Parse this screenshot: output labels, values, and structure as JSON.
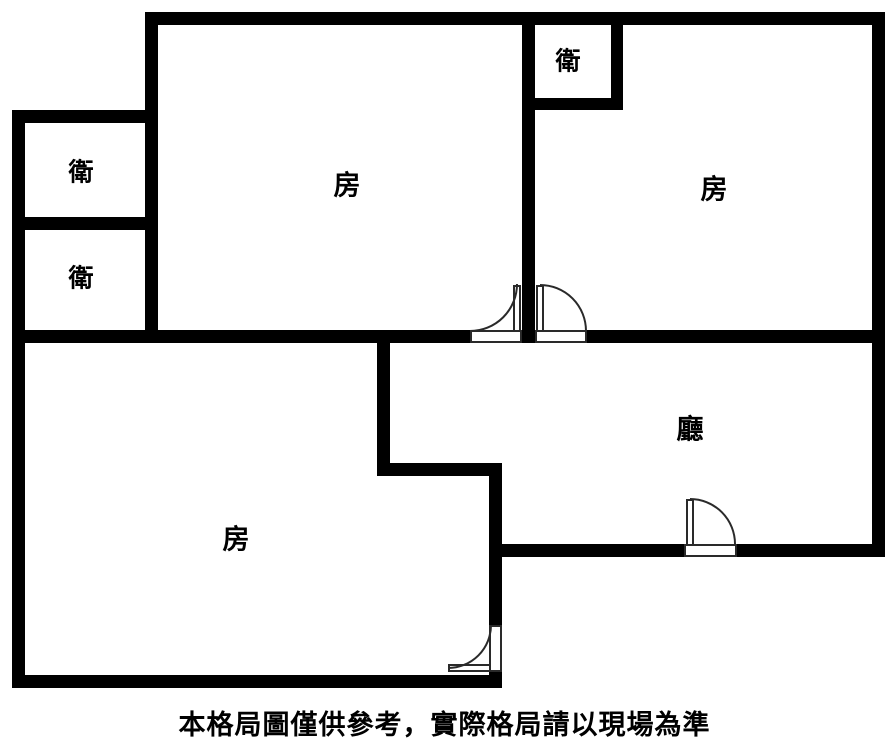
{
  "plan": {
    "background_color": "#ffffff",
    "wall_color": "#000000",
    "door_line_color": "#2a2a2a"
  },
  "rooms": [
    {
      "id": "bathroom-upper-left",
      "label": "衛"
    },
    {
      "id": "bathroom-lower-left",
      "label": "衛"
    },
    {
      "id": "bathroom-top-right",
      "label": "衛"
    },
    {
      "id": "bedroom-top-center",
      "label": "房"
    },
    {
      "id": "bedroom-top-right",
      "label": "房"
    },
    {
      "id": "bedroom-bottom-left",
      "label": "房"
    },
    {
      "id": "living-room",
      "label": "廳"
    }
  ],
  "caption": {
    "text": "本格局圖僅供參考，實際格局請以現場為準"
  }
}
